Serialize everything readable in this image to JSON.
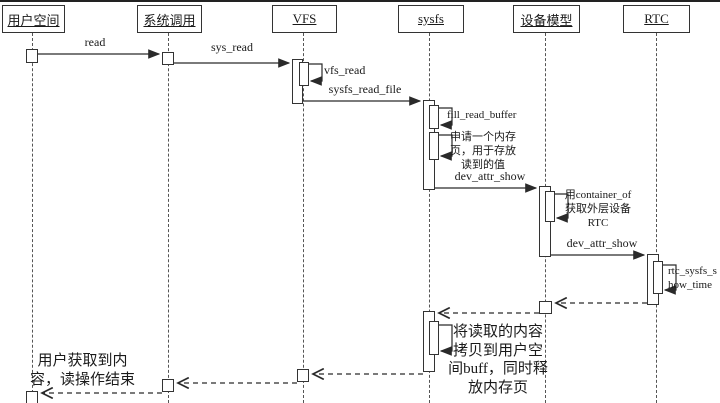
{
  "diagram_type": "uml-sequence-diagram",
  "colors": {
    "line": "#2a2a2a",
    "background": "#ffffff",
    "text": "#1a1a1a"
  },
  "lifelines": [
    {
      "label": "用户空间"
    },
    {
      "label": "系统调用"
    },
    {
      "label": "VFS"
    },
    {
      "label": "sysfs"
    },
    {
      "label": "设备模型"
    },
    {
      "label": "RTC"
    }
  ],
  "messages": {
    "read": "read",
    "sys_read": "sys_read",
    "vfs_read": "vfs_read",
    "sysfs_read_file": "sysfs_read_file",
    "fill_read_buffer": "fill_read_buffer",
    "dev_attr_show_1": "dev_attr_show",
    "dev_attr_show_2": "dev_attr_show"
  },
  "self_notes": {
    "alloc_page": {
      "lines": [
        "申请一个内存",
        "页，用于存放",
        "读到的值"
      ]
    },
    "container_of": {
      "lines": [
        "用container_of",
        "获取外层设备",
        "RTC"
      ]
    },
    "rtc_show_time": {
      "lines": [
        "rtc_sysfs_s",
        "how_time"
      ]
    },
    "copy_to_user": {
      "lines": [
        "将读取的内容",
        "拷贝到用户空",
        "间buff，同时释",
        "放内存页"
      ]
    }
  },
  "notes": {
    "end_note": {
      "lines": [
        "用户获取到内",
        "容，读操作结束"
      ]
    }
  }
}
